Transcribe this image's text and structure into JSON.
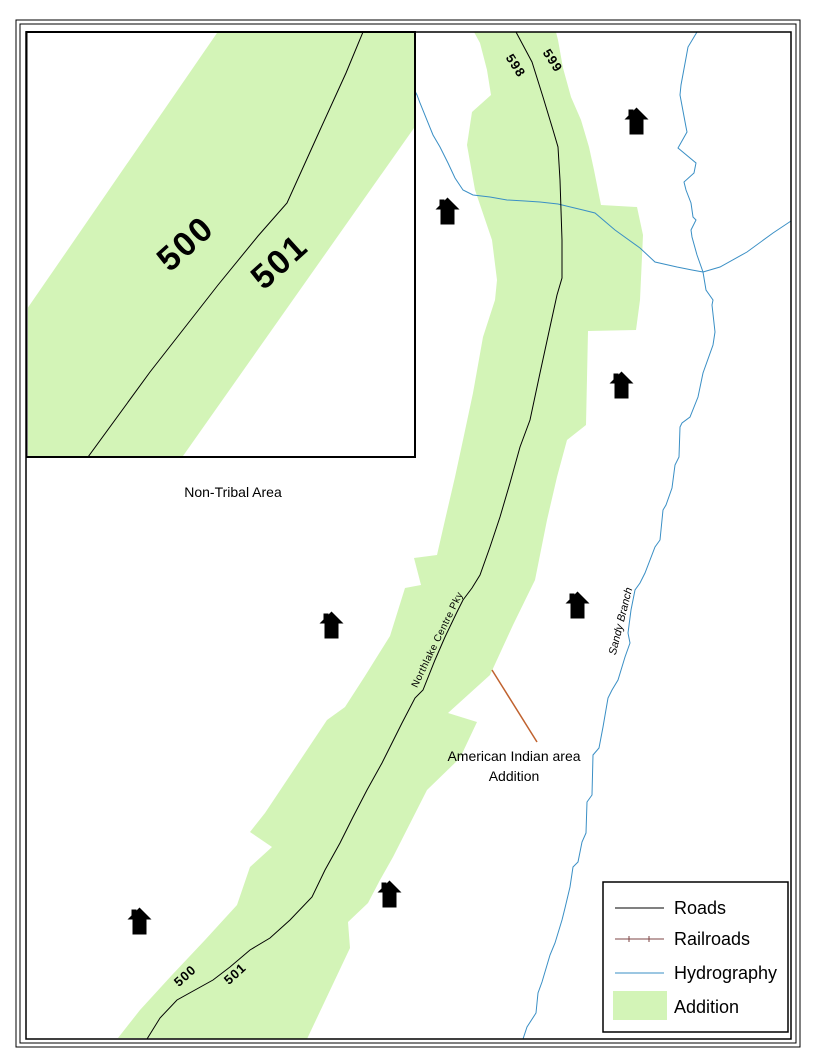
{
  "map": {
    "non_tribal_area": "Non-Tribal Area",
    "annotation_line1": "American Indian area",
    "annotation_line2": "Addition",
    "road_name": "Northlake Centre Pky",
    "stream_name": "Sandy Branch",
    "parcels": {
      "p598": "598",
      "p599": "599",
      "p500": "500",
      "p501": "501"
    }
  },
  "inset": {
    "p500": "500",
    "p501": "501"
  },
  "legend": {
    "items": [
      {
        "label": "Roads",
        "type": "road-line"
      },
      {
        "label": "Railroads",
        "type": "railroad-line"
      },
      {
        "label": "Hydrography",
        "type": "hydro-line"
      },
      {
        "label": "Addition",
        "type": "area-swatch"
      }
    ]
  },
  "colors": {
    "addition": "#d3f4b7",
    "hydrography": "#3a8fc5",
    "railroad": "#7d4444",
    "road": "#000000",
    "leader": "#c0622f",
    "stream_label": "#3a8fc5"
  }
}
